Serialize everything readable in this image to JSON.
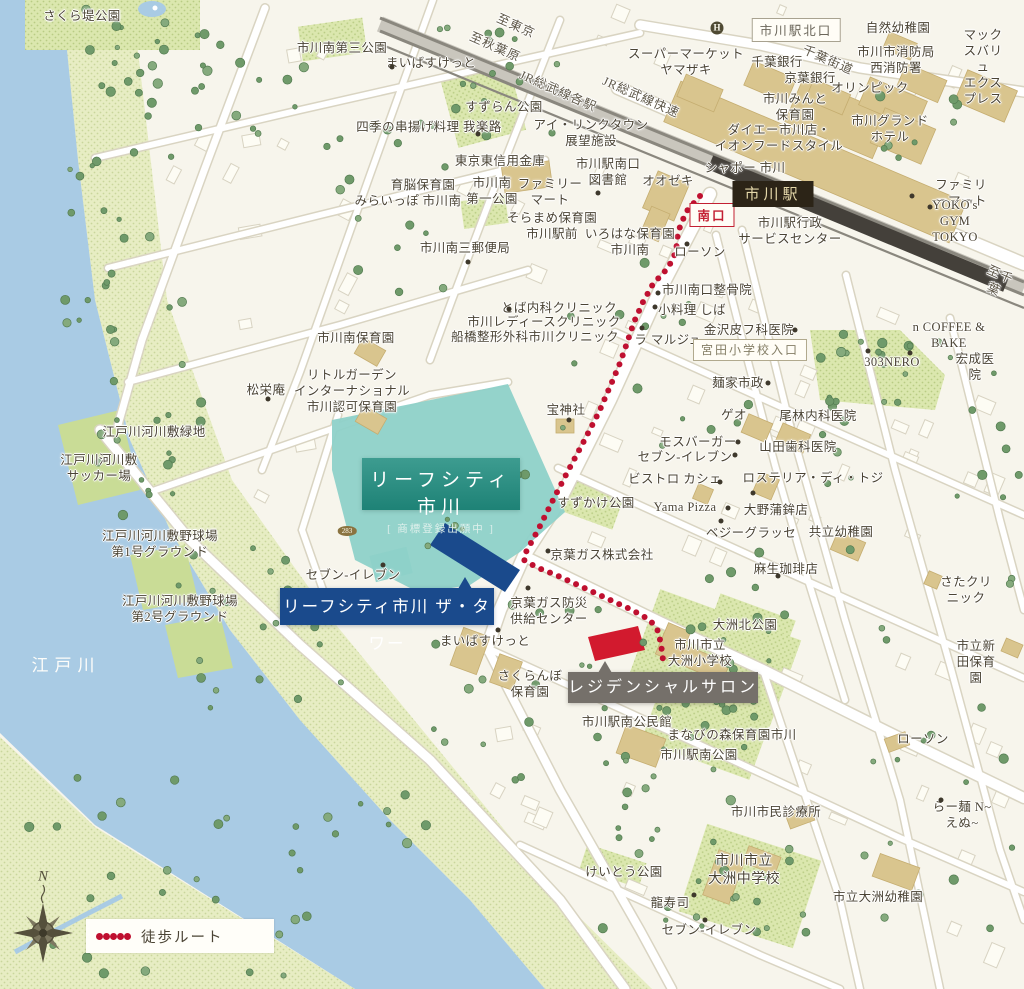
{
  "colors": {
    "bg": "#f7f5ec",
    "text": "#4b4435",
    "river": "#a9cbe4",
    "bank": "#e7edc3",
    "bank_dot": "#c9d69c",
    "park": "#dbe7ae",
    "park_dot": "#b9cc84",
    "field": "#c9dc96",
    "road": "#ffffff",
    "road_casing": "#d9d4c2",
    "rail": "#8a877e",
    "rail_dark": "#44403a",
    "building_tan": "#d9c58e",
    "building_tan_edge": "#c5ad70",
    "building_white": "#fdfcf4",
    "building_white_edge": "#d8d3c2",
    "tree": "#6f9a6a",
    "tree_edge": "#547c51",
    "teal_zone": "#8ed1c9",
    "teal_box": "#2f9488",
    "navy": "#1a4a8c",
    "red_building": "#d21a2e",
    "graybox": "#75706a",
    "route": "#bf1030"
  },
  "callouts": {
    "leaf": {
      "title": "リーフシティ市川",
      "sub": "[ 商標登録出願中 ]",
      "x": 362,
      "y": 458,
      "w": 158,
      "h": 52
    },
    "tower": {
      "label": "リーフシティ市川 ザ・タワー",
      "x": 280,
      "y": 588,
      "w": 214,
      "h": 37
    },
    "salon": {
      "label": "レジデンシャルサロン",
      "x": 568,
      "y": 672,
      "w": 190,
      "h": 31
    }
  },
  "legend": {
    "label": "徒歩ルート",
    "dots": 5
  },
  "compass": {
    "label": "N"
  },
  "route": {
    "points": [
      [
        700,
        196
      ],
      [
        686,
        212
      ],
      [
        678,
        232
      ],
      [
        676,
        252
      ],
      [
        668,
        268
      ],
      [
        653,
        284
      ],
      [
        643,
        302
      ],
      [
        634,
        322
      ],
      [
        627,
        343
      ],
      [
        620,
        363
      ],
      [
        612,
        382
      ],
      [
        599,
        412
      ],
      [
        584,
        441
      ],
      [
        568,
        471
      ],
      [
        553,
        500
      ],
      [
        538,
        530
      ],
      [
        526,
        552
      ],
      [
        524,
        560
      ],
      [
        536,
        567
      ],
      [
        556,
        575
      ],
      [
        580,
        586
      ],
      [
        606,
        598
      ],
      [
        632,
        610
      ],
      [
        650,
        620
      ],
      [
        658,
        631
      ],
      [
        661,
        644
      ],
      [
        663,
        660
      ]
    ]
  },
  "red_building": {
    "points": "588,637 638,626 645,650 595,661"
  },
  "navy_building": {
    "points": "445,523 520,570 505,592 430,545"
  },
  "boxed_labels": [
    {
      "t": "市川駅北口",
      "x": 796,
      "y": 30,
      "s": "outline"
    },
    {
      "t": "南口",
      "x": 712,
      "y": 215,
      "s": "red"
    },
    {
      "t": "宮田小学校入口",
      "x": 750,
      "y": 350,
      "s": "olive"
    },
    {
      "t": "市川駅",
      "x": 773,
      "y": 194,
      "s": "dark"
    }
  ],
  "badges": [
    {
      "t": "283",
      "x": 347,
      "y": 531,
      "cls": ""
    },
    {
      "t": "H",
      "x": 717,
      "y": 28,
      "cls": "hotel"
    }
  ],
  "labels": [
    {
      "t": "さくら堤公園",
      "x": 82,
      "y": 16
    },
    {
      "t": "市川南第三公園",
      "x": 342,
      "y": 48
    },
    {
      "t": "まいばすけっと",
      "x": 431,
      "y": 63,
      "d": [
        392,
        67
      ]
    },
    {
      "t": "すずらん公園",
      "x": 504,
      "y": 107
    },
    {
      "t": "四季の串揚げ料理 我楽路",
      "x": 429,
      "y": 127,
      "d": [
        478,
        134
      ]
    },
    {
      "t": "アイ・リンクタウン\n展望施設",
      "x": 591,
      "y": 133
    },
    {
      "t": "東京東信用金庫",
      "x": 500,
      "y": 161
    },
    {
      "t": "市川駅南口\n図書館",
      "x": 608,
      "y": 172
    },
    {
      "t": "オオゼキ",
      "x": 668,
      "y": 181
    },
    {
      "t": "育脳保育園",
      "x": 423,
      "y": 185
    },
    {
      "t": "みらいっぽ 市川南",
      "x": 408,
      "y": 201
    },
    {
      "t": "市川南\n第一公園",
      "x": 492,
      "y": 191
    },
    {
      "t": "ファミリー\nマート",
      "x": 550,
      "y": 192,
      "d": [
        598,
        193
      ]
    },
    {
      "t": "そらまめ保育園\n市川駅前",
      "x": 552,
      "y": 226
    },
    {
      "t": "いろはな保育園\n市川南",
      "x": 630,
      "y": 242
    },
    {
      "t": "市川南三郵便局",
      "x": 465,
      "y": 248,
      "d": [
        468,
        262
      ]
    },
    {
      "t": "スーパーマーケット\nヤマザキ",
      "x": 686,
      "y": 62
    },
    {
      "t": "自然幼稚園",
      "x": 898,
      "y": 28
    },
    {
      "t": "市川市消防局\n西消防署",
      "x": 896,
      "y": 60
    },
    {
      "t": "マックスバリュ\nエクスプレス",
      "x": 983,
      "y": 67
    },
    {
      "t": "千葉銀行",
      "x": 777,
      "y": 62
    },
    {
      "t": "千葉街道",
      "x": 828,
      "y": 60,
      "r": 24,
      "c": "road"
    },
    {
      "t": "京葉銀行",
      "x": 810,
      "y": 78
    },
    {
      "t": "オリンピック",
      "x": 870,
      "y": 88
    },
    {
      "t": "市川みんと\n保育園",
      "x": 795,
      "y": 107
    },
    {
      "t": "市川グランド\nホテル",
      "x": 890,
      "y": 129
    },
    {
      "t": "ダイエー市川店・\nイオンフードスタイル",
      "x": 779,
      "y": 138
    },
    {
      "t": "シャポー 市川",
      "x": 745,
      "y": 168
    },
    {
      "t": "市川駅行政\nサービスセンター",
      "x": 790,
      "y": 231
    },
    {
      "t": "ファミリーマート",
      "x": 961,
      "y": 193,
      "d": [
        912,
        196
      ]
    },
    {
      "t": "YOKO's GYM TOKYO",
      "x": 955,
      "y": 221,
      "d": [
        930,
        207
      ]
    },
    {
      "t": "至東京",
      "x": 516,
      "y": 26,
      "r": 24,
      "c": "road"
    },
    {
      "t": "至秋葉原",
      "x": 495,
      "y": 47,
      "r": 24,
      "c": "road"
    },
    {
      "t": "JR総武線各駅",
      "x": 558,
      "y": 91,
      "r": 24,
      "c": "road"
    },
    {
      "t": "JR総武線快速",
      "x": 641,
      "y": 97,
      "r": 24,
      "c": "road"
    },
    {
      "t": "至千葉",
      "x": 997,
      "y": 282,
      "r": 24,
      "c": "road"
    },
    {
      "t": "ローソン",
      "x": 700,
      "y": 252,
      "d": [
        687,
        244
      ]
    },
    {
      "t": "市川南口整骨院",
      "x": 707,
      "y": 290,
      "d": [
        658,
        293
      ]
    },
    {
      "t": "小料理 しば",
      "x": 692,
      "y": 310,
      "d": [
        655,
        307
      ]
    },
    {
      "t": "金沢皮フ科医院",
      "x": 749,
      "y": 330,
      "d": [
        795,
        330
      ]
    },
    {
      "t": "ラ マルジュ",
      "x": 668,
      "y": 340,
      "d": [
        642,
        328
      ]
    },
    {
      "t": "とば内科クリニック",
      "x": 559,
      "y": 308,
      "d": [
        509,
        309
      ]
    },
    {
      "t": "市川レディースクリニック",
      "x": 544,
      "y": 322
    },
    {
      "t": "船橋整形外科市川クリニック",
      "x": 535,
      "y": 337
    },
    {
      "t": "n COFFEE & BAKE",
      "x": 949,
      "y": 335,
      "d": [
        910,
        353
      ]
    },
    {
      "t": "303NERO",
      "x": 892,
      "y": 362,
      "d": [
        868,
        351
      ]
    },
    {
      "t": "宏成医院",
      "x": 975,
      "y": 367
    },
    {
      "t": "麺家市政",
      "x": 738,
      "y": 383,
      "d": [
        768,
        383
      ]
    },
    {
      "t": "ゲオ",
      "x": 734,
      "y": 415
    },
    {
      "t": "尾林内科医院",
      "x": 818,
      "y": 416
    },
    {
      "t": "モスバーガー",
      "x": 698,
      "y": 442,
      "d": [
        738,
        442
      ]
    },
    {
      "t": "セブン-イレブン",
      "x": 685,
      "y": 457,
      "d": [
        735,
        455
      ]
    },
    {
      "t": "山田歯科医院",
      "x": 798,
      "y": 447
    },
    {
      "t": "ビストロ カシェ",
      "x": 675,
      "y": 479,
      "d": [
        720,
        482
      ]
    },
    {
      "t": "ロステリア・ディ・トジ",
      "x": 813,
      "y": 478
    },
    {
      "t": "Yama Pizza",
      "x": 685,
      "y": 507,
      "d": [
        728,
        508
      ]
    },
    {
      "t": "大野蒲鉾店",
      "x": 776,
      "y": 510,
      "d": [
        753,
        493
      ]
    },
    {
      "t": "ベジーグラッセ",
      "x": 751,
      "y": 533,
      "d": [
        721,
        521
      ]
    },
    {
      "t": "共立幼稚園",
      "x": 841,
      "y": 532
    },
    {
      "t": "麻生珈琲店",
      "x": 786,
      "y": 569,
      "d": [
        778,
        576
      ]
    },
    {
      "t": "さたクリニック",
      "x": 966,
      "y": 590
    },
    {
      "t": "大洲北公園",
      "x": 745,
      "y": 625
    },
    {
      "t": "市川市立\n大洲小学校",
      "x": 700,
      "y": 653
    },
    {
      "t": "市立新田保育園",
      "x": 976,
      "y": 662
    },
    {
      "t": "市川南保育園",
      "x": 356,
      "y": 338
    },
    {
      "t": "リトルガーデン\nインターナショナル\n市川認可保育園",
      "x": 352,
      "y": 391
    },
    {
      "t": "松栄庵",
      "x": 266,
      "y": 390,
      "d": [
        268,
        399
      ]
    },
    {
      "t": "宝神社",
      "x": 566,
      "y": 410,
      "d": [
        569,
        420
      ]
    },
    {
      "t": "すずかけ公園",
      "x": 596,
      "y": 503
    },
    {
      "t": "セブン-イレブン",
      "x": 353,
      "y": 575,
      "d": [
        383,
        565
      ]
    },
    {
      "t": "京葉ガス株式会社",
      "x": 602,
      "y": 555,
      "d": [
        548,
        551
      ]
    },
    {
      "t": "京葉ガス防災\n供給センター",
      "x": 549,
      "y": 611,
      "d": [
        528,
        588
      ]
    },
    {
      "t": "まいばすけっと",
      "x": 485,
      "y": 641,
      "d": [
        498,
        630
      ]
    },
    {
      "t": "さくらんぼ\n保育園",
      "x": 530,
      "y": 684
    },
    {
      "t": "市川駅南公民館",
      "x": 627,
      "y": 722
    },
    {
      "t": "まなびの森保育園市川",
      "x": 732,
      "y": 735
    },
    {
      "t": "市川駅南公園",
      "x": 699,
      "y": 755
    },
    {
      "t": "ローソン",
      "x": 923,
      "y": 739
    },
    {
      "t": "市川市民診療所",
      "x": 776,
      "y": 812
    },
    {
      "t": "らー麺 N~えぬ~",
      "x": 962,
      "y": 815,
      "d": [
        941,
        800
      ]
    },
    {
      "t": "けいとう公園",
      "x": 624,
      "y": 872
    },
    {
      "t": "市川市立\n大洲中学校",
      "x": 744,
      "y": 871,
      "f": 14
    },
    {
      "t": "龍寿司",
      "x": 670,
      "y": 903,
      "d": [
        694,
        895
      ]
    },
    {
      "t": "セブン-イレブン",
      "x": 709,
      "y": 930,
      "d": [
        705,
        920
      ]
    },
    {
      "t": "市立大洲幼稚園",
      "x": 878,
      "y": 897
    },
    {
      "t": "江戸川河川敷緑地",
      "x": 154,
      "y": 432
    },
    {
      "t": "江戸川河川敷\nサッカー場",
      "x": 99,
      "y": 468
    },
    {
      "t": "江戸川河川敷野球場\n第1号グラウンド",
      "x": 160,
      "y": 544
    },
    {
      "t": "江戸川河川敷野球場\n第2号グラウンド",
      "x": 180,
      "y": 609
    },
    {
      "t": "江戸川",
      "x": 66,
      "y": 666,
      "c": "water"
    }
  ]
}
